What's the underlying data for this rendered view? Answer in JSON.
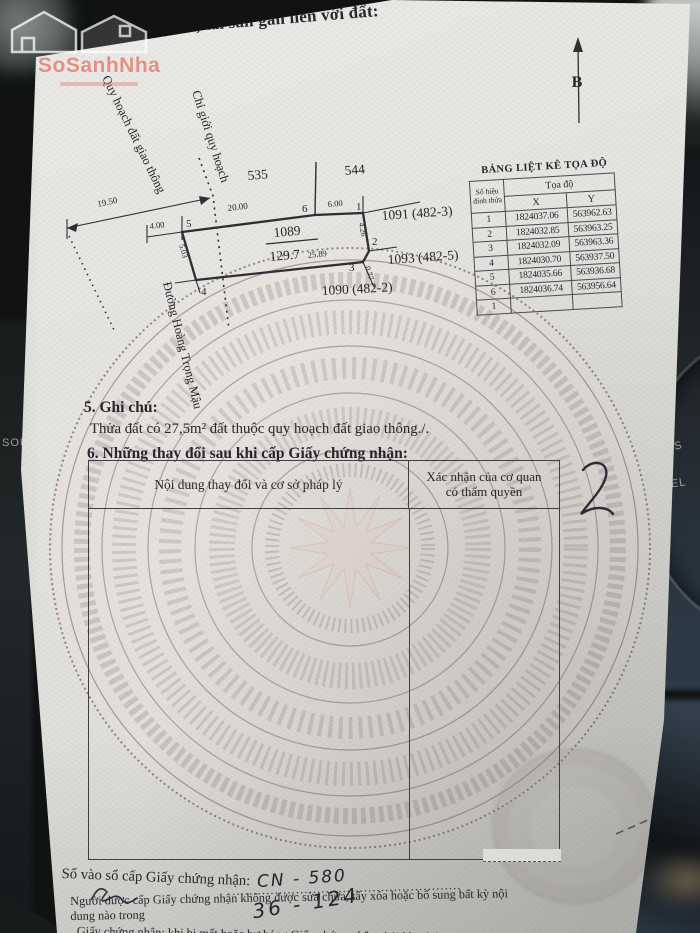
{
  "logo": {
    "brand": "SoSanhNha"
  },
  "background": {
    "label_sour": "SOUR",
    "label_es": "ES",
    "label_cel": "CEL"
  },
  "page": {
    "section4_title": "4. Sơ đồ thửa đất, tài sản gắn liền với đất:"
  },
  "diagram": {
    "north_label": "B",
    "parcel": {
      "number": "1089",
      "area": "129.7"
    },
    "neighbors": {
      "top_left": "535",
      "top_right": "544",
      "right_upper": "1091 (482-3)",
      "right_lower": "1093 (482-5)",
      "bottom": "1090 (482-2)"
    },
    "street_label": "Đường Hoàng Trọng Mậu",
    "planning_label": "Quy hoạch đất giao thông",
    "boundary_label": "Chỉ giới quy hoạch",
    "dims": {
      "offset_left": "19.50",
      "left_ext": "4.00",
      "top_main": "20.00",
      "top_right": "6.00",
      "right_upper": "4.26",
      "right_lower": "0.77",
      "bottom": "25.89",
      "left_side": "5.03"
    },
    "vertices": [
      "1",
      "2",
      "3",
      "4",
      "5",
      "6"
    ]
  },
  "coord_table": {
    "title": "BẢNG LIỆT KÊ TỌA ĐỘ",
    "col_vertex": "Số hiệu đỉnh thửa",
    "col_coord": "Tọa độ",
    "col_x": "X",
    "col_y": "Y",
    "rows": [
      {
        "id": "1",
        "x": "1824037.06",
        "y": "563962.63"
      },
      {
        "id": "2",
        "x": "1824032.85",
        "y": "563963.25"
      },
      {
        "id": "3",
        "x": "1824032.09",
        "y": "563963.36"
      },
      {
        "id": "4",
        "x": "1824030.70",
        "y": "563937.50"
      },
      {
        "id": "5",
        "x": "1824035.66",
        "y": "563936.68"
      },
      {
        "id": "6",
        "x": "1824036.74",
        "y": "563956.64"
      },
      {
        "id": "1",
        "x": "",
        "y": ""
      }
    ]
  },
  "section5": {
    "title": "5. Ghi chú:",
    "body": "Thửa đất có 27,5m² đất thuộc quy hoạch đất giao thông./."
  },
  "section6": {
    "title": "6. Những thay đổi sau khi cấp Giấy chứng nhận:",
    "col_left": "Nội dung thay đổi và cơ sở pháp lý",
    "col_right_line1": "Xác nhận của cơ quan",
    "col_right_line2": "có thẩm quyền"
  },
  "footer": {
    "serial_label": "Số vào sổ cấp Giấy chứng nhận:",
    "serial_dots": "......................................................",
    "serial_handwritten": "CN - 580",
    "handwritten_note": "36 - 124",
    "legal_line1": "Người được cấp Giấy chứng nhận không được sửa chữa, tẩy xóa hoặc bổ sung bất kỳ nội dung nào trong",
    "legal_line2": "Giấy chứng nhận; khi bị mất hoặc hư hỏng Giấy chứng nhận phải khai báo ngay với cơ quan cấp Giấy"
  }
}
